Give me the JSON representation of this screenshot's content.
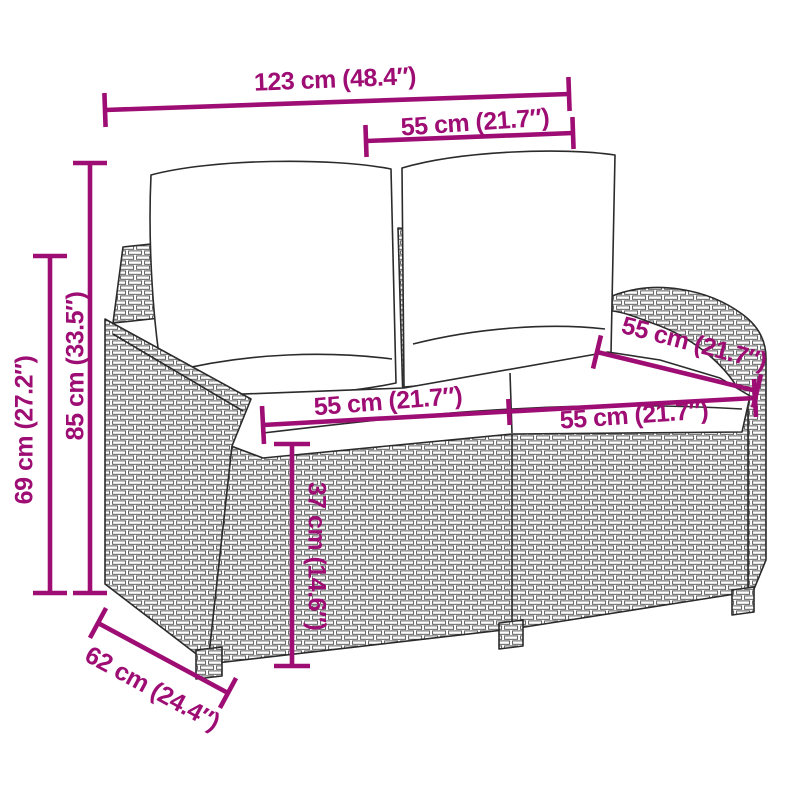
{
  "figure": {
    "subject": "Line drawing of a poly rattan two-seater garden bench with back and seat cushions",
    "background": "#ffffff"
  },
  "colors": {
    "dimension_accent": "#9E0D73",
    "line_art": "#2b2b2b"
  },
  "dimensions": [
    {
      "id": "overall-width",
      "label": "123 cm (48.4″)"
    },
    {
      "id": "backrest-cushion-width",
      "label": "55 cm (21.7″)"
    },
    {
      "id": "overall-height",
      "label": "85 cm (33.5″)"
    },
    {
      "id": "arm-height",
      "label": "69 cm (27.2″)"
    },
    {
      "id": "seat-width-left",
      "label": "55 cm (21.7″)"
    },
    {
      "id": "seat-width-right",
      "label": "55 cm (21.7″)"
    },
    {
      "id": "seat-depth",
      "label": "55 cm (21.7″)"
    },
    {
      "id": "seat-height",
      "label": "37 cm (14.6″)"
    },
    {
      "id": "overall-depth",
      "label": "62 cm (24.4″)"
    }
  ]
}
